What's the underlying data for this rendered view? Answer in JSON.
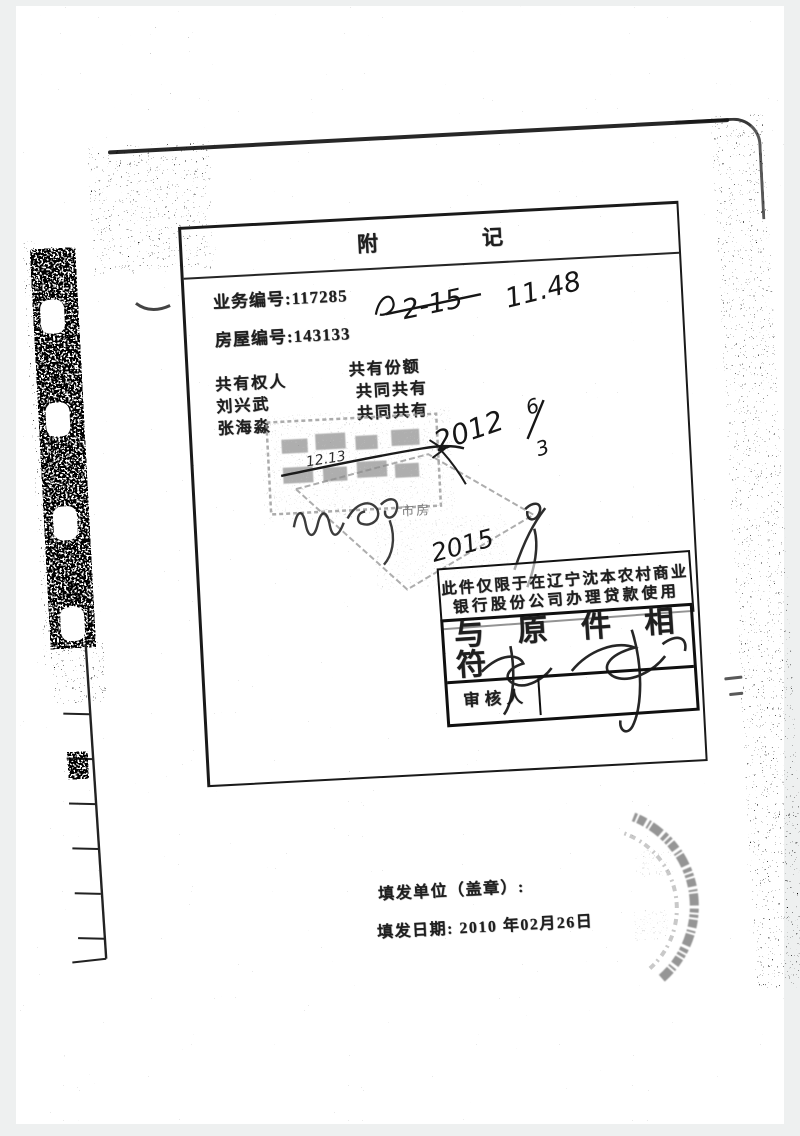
{
  "doc": {
    "title": {
      "left": "附",
      "right": "记"
    },
    "fields": {
      "business": {
        "label": "业务编号:",
        "value": "117285"
      },
      "house": {
        "label": "房屋编号:",
        "value": "143133"
      }
    },
    "owners": {
      "col1": "共有权人",
      "col2": "共有份额",
      "rows": [
        {
          "name": "刘兴武",
          "share": "共同共有"
        },
        {
          "name": "张海淼",
          "share": "共同共有"
        }
      ]
    },
    "bank_stamp": {
      "line1": "此件仅限于在辽宁沈本农村商业",
      "line2": "银行股份公司办理贷款使用"
    },
    "verify": {
      "title": "与 原 件 相 符",
      "reviewer_label": "审核人"
    },
    "footer": {
      "issuer_label": "填发单位（盖章）:",
      "date_label": "填发日期:",
      "date_value": "2010 年02月26日"
    },
    "handwriting": {
      "mark_top1": "2-15",
      "mark_top2": "11.48",
      "mark_line": "12.13",
      "mark_mid_year": "2012",
      "frac_num": "6",
      "frac_den": "3",
      "mark_low": "2015"
    },
    "faint_stamp": {
      "text": "市房"
    },
    "ink_color": "#1a1a1a",
    "stamp_gray": "#8f8f8f"
  }
}
